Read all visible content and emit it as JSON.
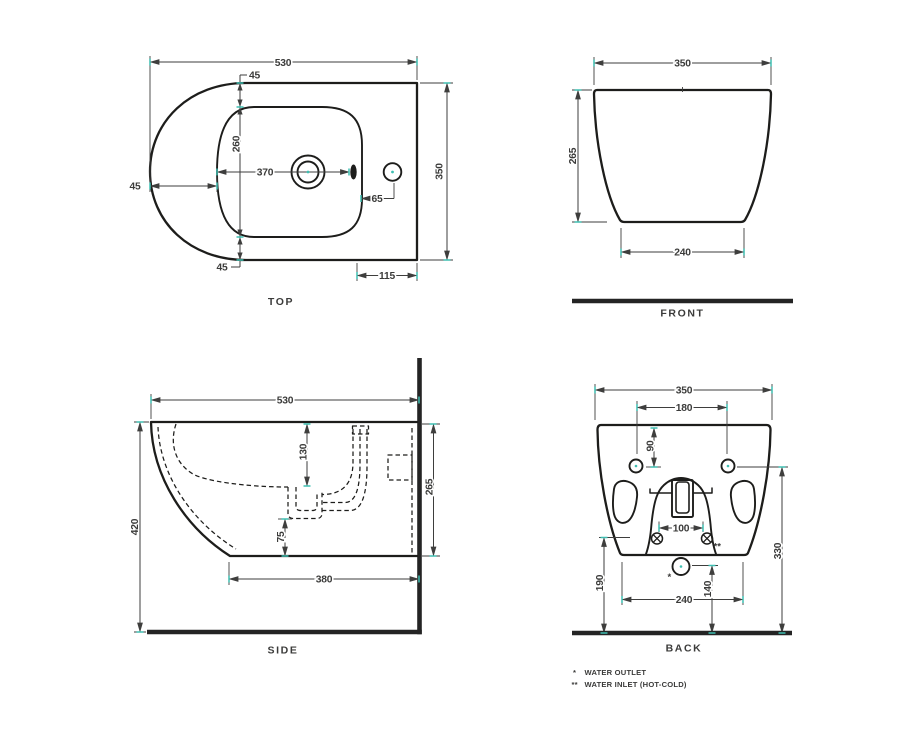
{
  "colors": {
    "line": "#1d1d1b",
    "dim": "#3e3e3d",
    "text": "#3b3b3a",
    "tick": "#3fbfb2",
    "wall": "#242424"
  },
  "views": {
    "top": {
      "title": "TOP",
      "dims": {
        "overall_width": "530",
        "rim_top": "45",
        "bowl_depth": "260",
        "tap_from_front": "370",
        "rim_left": "45",
        "side_hole_offset": "65",
        "overall_depth": "350",
        "rim_bottom": "45",
        "deck_length": "115"
      }
    },
    "front": {
      "title": "FRONT",
      "dims": {
        "overall_width": "350",
        "overall_height": "265",
        "base_width": "240"
      }
    },
    "side": {
      "title": "SIDE",
      "dims": {
        "overall_depth": "530",
        "bowl_depth": "130",
        "body_height": "265",
        "sump_clearance": "75",
        "overall_height": "420",
        "base_depth": "380"
      }
    },
    "back": {
      "title": "BACK",
      "dims": {
        "overall_width": "350",
        "fixing_holes_span": "180",
        "fixing_holes_drop": "90",
        "drain_slot_width": "100",
        "fixing_holes_height": "330",
        "inlet_height": "190",
        "outlet_height": "140",
        "base_width": "240"
      },
      "markers": {
        "outlet": "*",
        "inlet": "**"
      }
    }
  },
  "legend": [
    {
      "marker": "*",
      "label": "WATER OUTLET"
    },
    {
      "marker": "**",
      "label": "WATER INLET (HOT-COLD)"
    }
  ]
}
